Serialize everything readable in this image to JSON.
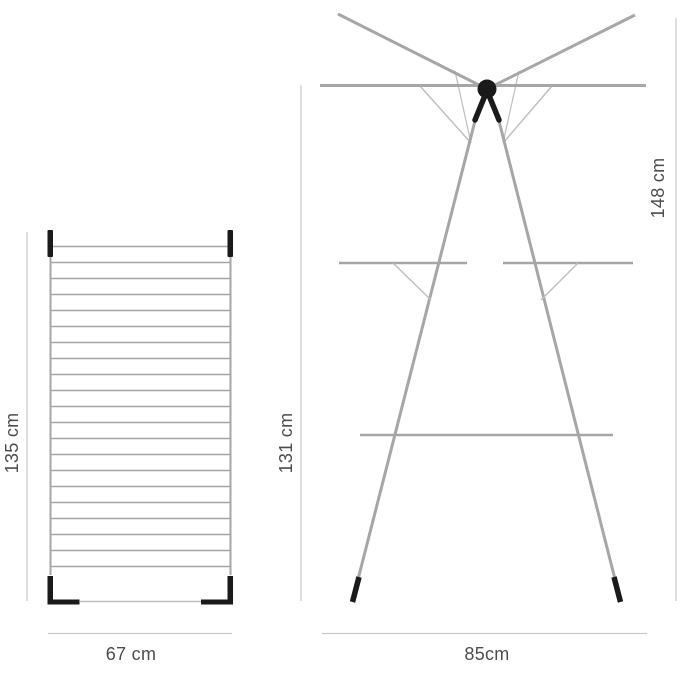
{
  "title": "Drying rack dimension diagram",
  "colors": {
    "bg": "#ffffff",
    "frame": "#a6a6a6",
    "wire": "#bdbdbd",
    "black": "#1a1a1a",
    "dim_line": "#c9c9c9",
    "text": "#4d4d4d"
  },
  "folded_view": {
    "name": "folded rack (front view)",
    "rung_count": 21,
    "height_label": "135 cm",
    "width_label": "67 cm"
  },
  "standing_view": {
    "name": "standing tower rack (side view)",
    "total_height_label": "148 cm",
    "frame_height_label": "131 cm",
    "base_width_label": "85cm"
  }
}
